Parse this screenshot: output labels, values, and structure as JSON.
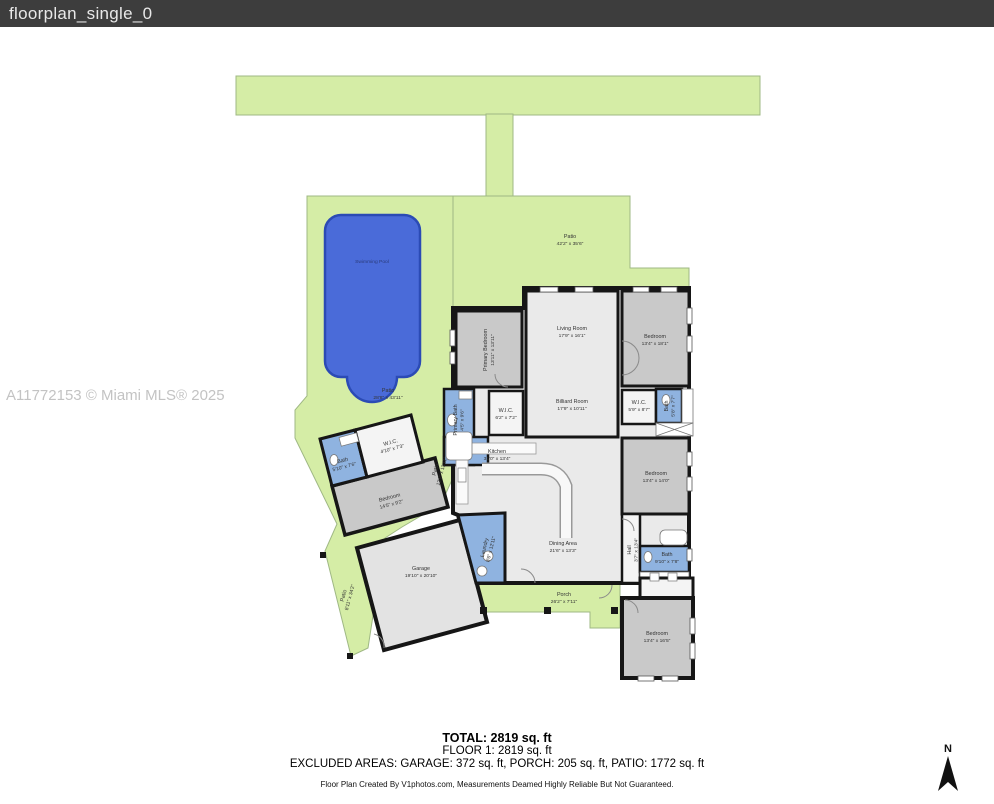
{
  "title_bar": {
    "filename": "floorplan_single_0"
  },
  "watermark": "A11772153 © Miami MLS® 2025",
  "summary": {
    "total": "TOTAL: 2819 sq. ft",
    "floor1": "FLOOR 1: 2819 sq. ft",
    "excluded": "EXCLUDED AREAS: GARAGE: 372 sq. ft, PORCH: 205 sq. ft, PATIO: 1772 sq. ft",
    "credit": "Floor Plan Created By V1photos.com, Measurements Deamed Highly Reliable But Not Guaranteed."
  },
  "compass": {
    "label": "N"
  },
  "rooms": {
    "pool": {
      "name": "Swimming Pool",
      "dims": ""
    },
    "patio_top": {
      "name": "Patio",
      "dims": "42'2\" x 35'6\""
    },
    "patio_pool": {
      "name": "Patio",
      "dims": "28'8\" x 43'11\""
    },
    "patio_side": {
      "name": "Patio",
      "dims": "12'0\" x 13'11\""
    },
    "patio_garage": {
      "name": "Patio",
      "dims": "8'11\" x 34'2\""
    },
    "primary_bedroom": {
      "name": "Primary Bedroom",
      "dims": "13'11\" x 13'11\""
    },
    "living": {
      "name": "Living Room",
      "dims": "17'9\" x 16'1\""
    },
    "bedroom_tr": {
      "name": "Bedroom",
      "dims": "13'4\" x 18'1\""
    },
    "wic_left": {
      "name": "W.I.C.",
      "dims": "6'2\" x 7'2\""
    },
    "wic_right": {
      "name": "W.I.C.",
      "dims": "5'9\" x 8'7\""
    },
    "primary_bath": {
      "name": "Primary Bath",
      "dims": "4'5\" x 9'6\""
    },
    "bath_tr": {
      "name": "Bath",
      "dims": "5'8\" x 7'7\""
    },
    "billiard": {
      "name": "Billiard Room",
      "dims": "17'9\" x 10'11\""
    },
    "kitchen": {
      "name": "Kitchen",
      "dims": "31'0\" x 13'4\""
    },
    "dining": {
      "name": "Dining Area",
      "dims": "21'6\" x 13'3\""
    },
    "bedroom_mid": {
      "name": "Bedroom",
      "dims": "13'4\" x 14'0\""
    },
    "bath_mid": {
      "name": "Bath",
      "dims": "9'10\" x 7'8\""
    },
    "hall": {
      "name": "Hall",
      "dims": "3'7\" x 13'4\""
    },
    "laundry": {
      "name": "Laundry",
      "dims": "8'6\" x 12'11\""
    },
    "bedroom_wing": {
      "name": "Bedroom",
      "dims": "14'5\" x 9'2\""
    },
    "bath_wing": {
      "name": "Bath",
      "dims": "5'10\" x 7'6\""
    },
    "wic_wing": {
      "name": "W.I.C.",
      "dims": "4'10\" x 7'3\""
    },
    "garage": {
      "name": "Garage",
      "dims": "19'10\" x 20'10\""
    },
    "porch": {
      "name": "Porch",
      "dims": "26'2\" x 7'11\""
    },
    "bedroom_br": {
      "name": "Bedroom",
      "dims": "13'4\" x 16'5\""
    }
  },
  "colors": {
    "titlebar_bg": "#3d3d3d",
    "lawn_green": "#d5eda6",
    "pool_blue": "#4a6bd9",
    "pool_border": "#2b4bb5",
    "bath_blue": "#8fb3e0",
    "bedroom_gray": "#c9c9c9",
    "floor_light": "#eaeaea",
    "wall_black": "#161616"
  }
}
